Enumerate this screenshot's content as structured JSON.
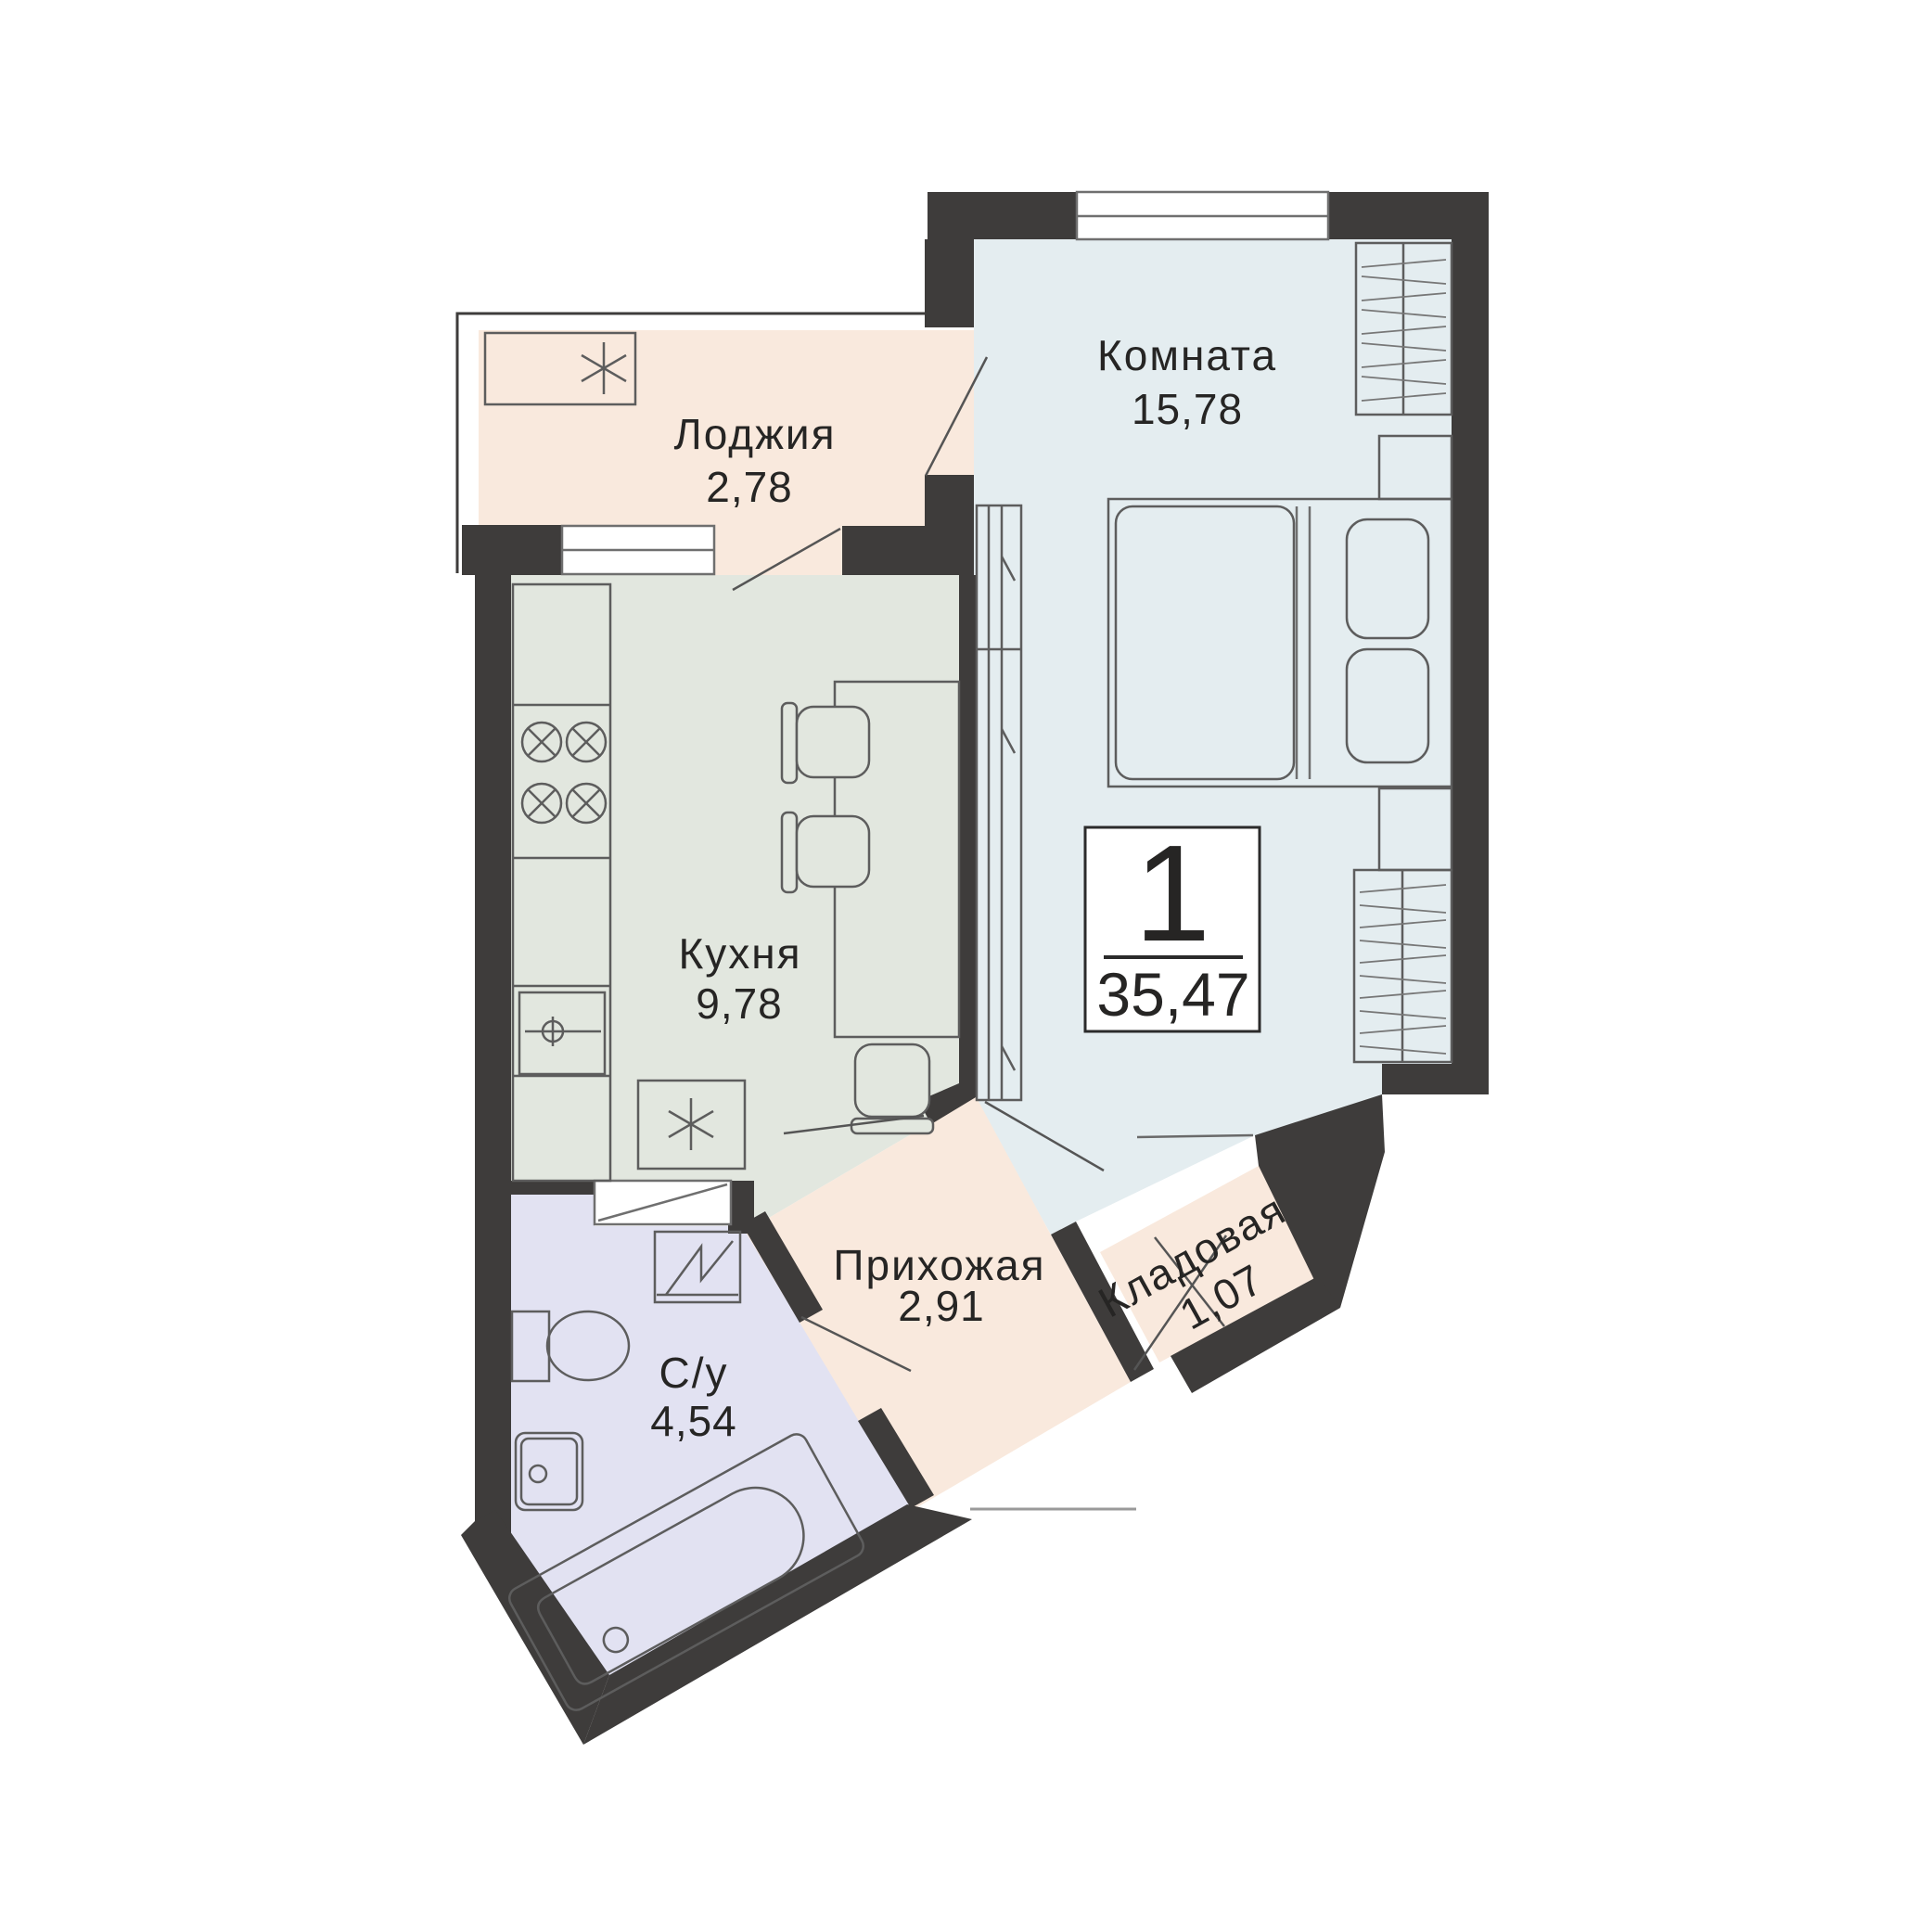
{
  "badge": {
    "rooms_count": "1",
    "total_area": "35,47"
  },
  "rooms": [
    {
      "key": "living",
      "name": "Комната",
      "area": "15,78"
    },
    {
      "key": "loggia",
      "name": "Лоджия",
      "area": "2,78"
    },
    {
      "key": "kitchen",
      "name": "Кухня",
      "area": "9,78"
    },
    {
      "key": "hallway",
      "name": "Прихожая",
      "area": "2,91"
    },
    {
      "key": "storage",
      "name": "Кладовая",
      "area": "1,07"
    },
    {
      "key": "bathroom",
      "name": "С/у",
      "area": "4,54"
    }
  ],
  "colors": {
    "wall": "#3e3c3b",
    "living": "#e4edf0",
    "loggia": "#f9e9dd",
    "kitchen": "#e2e7df",
    "hallway": "#f9e9dd",
    "storage": "#f9e9dd",
    "bathroom": "#e2e2f2",
    "window": "#ffffff",
    "furniture_line": "#5d5d5d",
    "text": "#262524"
  },
  "icons": {
    "ac_unit": "snowflake-icon",
    "fridge": "snowflake-icon",
    "stove": "burner-cross-icon",
    "kitchen_sink": "crosshair-icon",
    "washing_machine": "zigzag-icon"
  }
}
